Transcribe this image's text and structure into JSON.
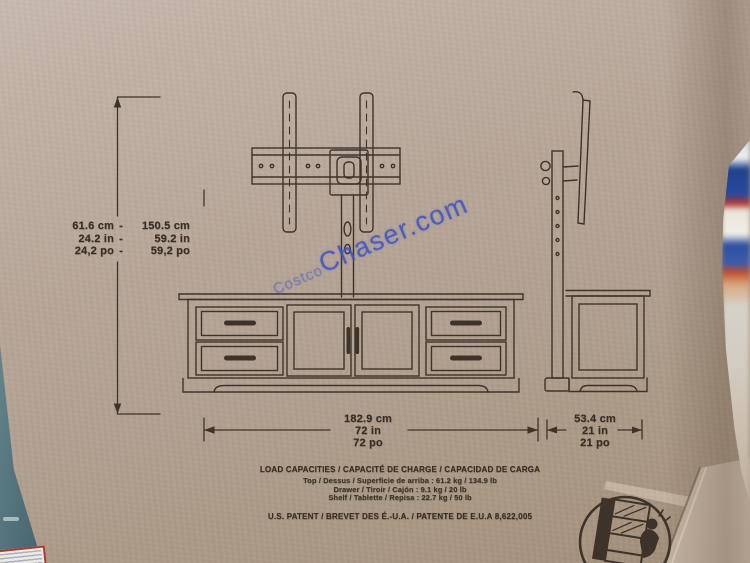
{
  "photo": {
    "description": "cardboard shipping box printed with TV-stand dimension diagram",
    "watermark": {
      "prefix": "Costco",
      "suffix": "Chaser.com",
      "color": "#3b51c4"
    },
    "dimensions": {
      "height": {
        "rows": [
          {
            "min": "61.6 cm",
            "dash": "-",
            "max": "150.5 cm"
          },
          {
            "min": "24.2 in",
            "dash": "-",
            "max": "59.2 in"
          },
          {
            "min": "24,2 po",
            "dash": "-",
            "max": "59,2 po"
          }
        ]
      },
      "width": {
        "lines": [
          "182.9 cm",
          "72 in",
          "72 po"
        ]
      },
      "depth": {
        "lines": [
          "53.4 cm",
          "21 in",
          "21 po"
        ]
      }
    },
    "load_capacities": {
      "title": "LOAD CAPACITIES / CAPACITÉ DE CHARGE / CAPACIDAD DE CARGA",
      "rows": [
        "Top / Dessus / Superficie de arriba : 61.2 kg / 134.9 lb",
        "Drawer / Tiroir / Cajón : 9.1 kg / 20 lb",
        "Shelf / Tablette / Repisa : 22.7 kg / 50 lb"
      ],
      "patent": "U.S. PATENT / BREVET DES É.-U.A. / PATENTE DE E.U.A 8,622,005"
    },
    "icons": {
      "tip_over_warning": "circle pictogram of child climbing a dresser"
    },
    "colors": {
      "cardboard": "#b1a090",
      "ink": "#3e332a",
      "watermark_blue": "#3b51c4",
      "adjacent_box_teal": "#4e6d77",
      "label_border_red": "#a63c30"
    }
  }
}
